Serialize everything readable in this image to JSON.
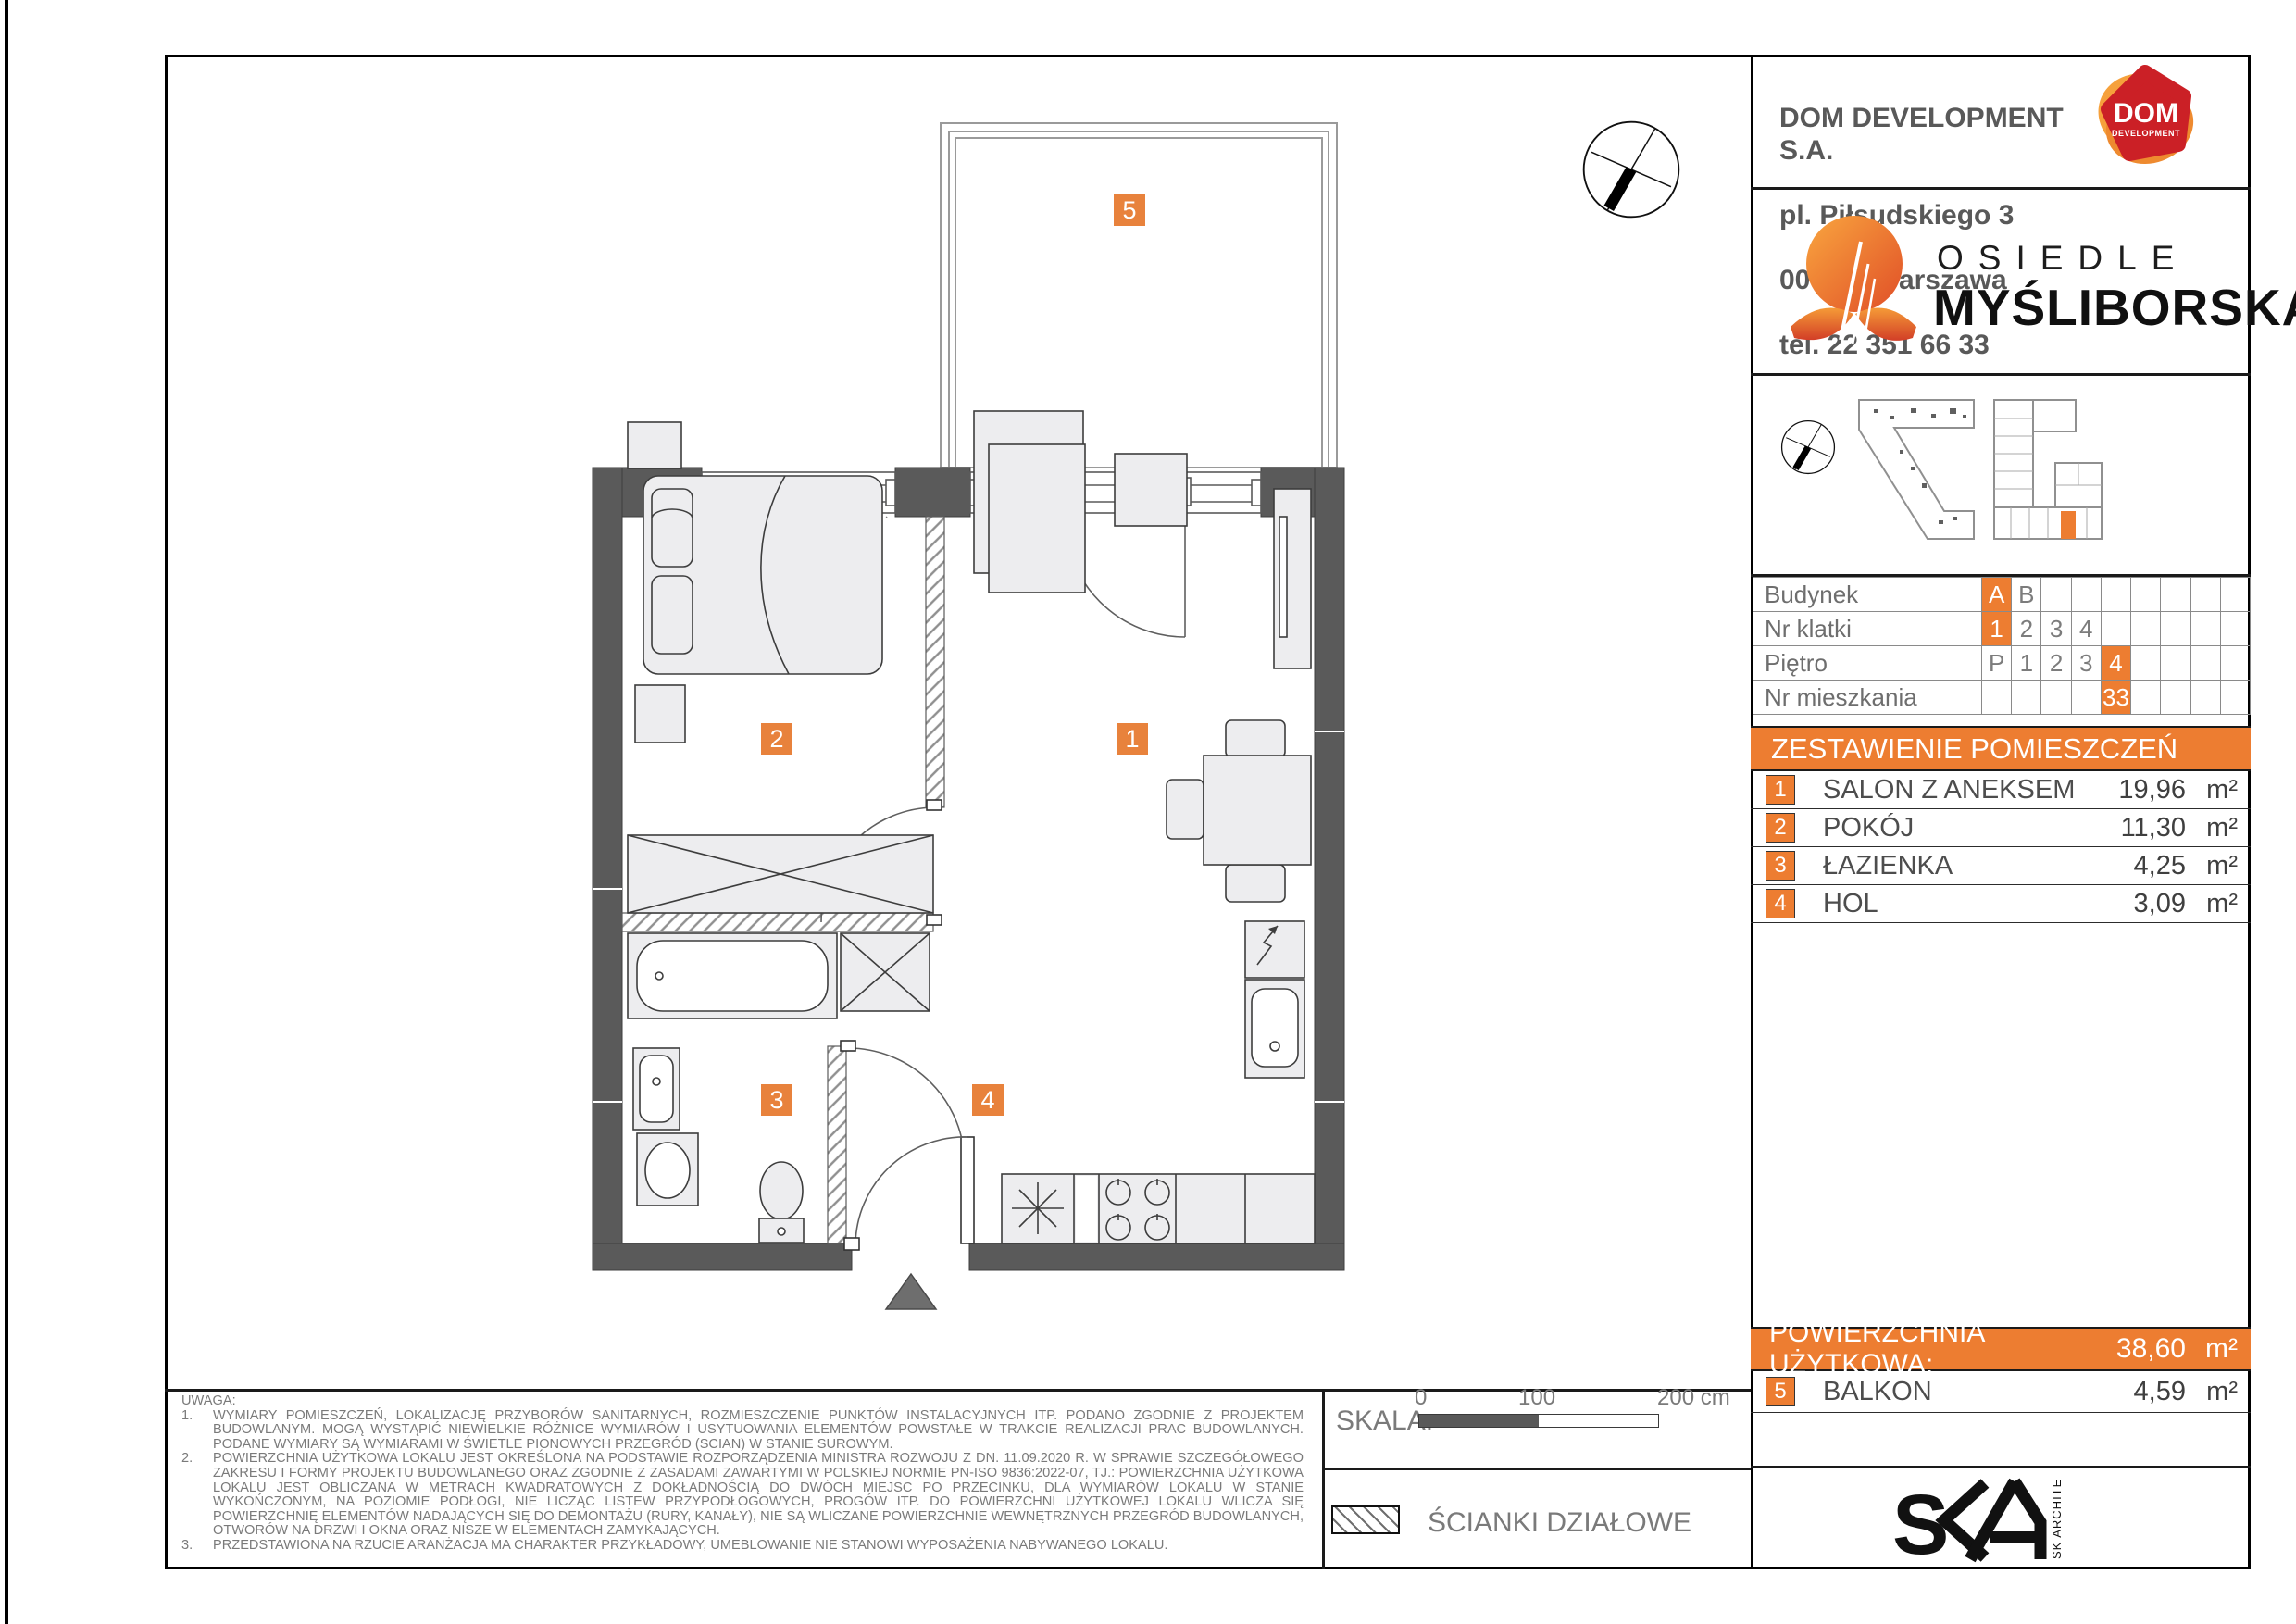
{
  "company": {
    "name": "DOM DEVELOPMENT S.A.",
    "address_line1": "pl. Piłsudskiego 3",
    "address_line2": "00-078 Warszawa",
    "phone": "tel. 22 351 66 33",
    "logo_text": "DOM",
    "logo_subtext": "DEVELOPMENT"
  },
  "project": {
    "prefix": "OSIEDLE",
    "name": "MYŚLIBORSKA"
  },
  "info_table": {
    "rows": [
      {
        "label": "Budynek",
        "cells": [
          {
            "t": "A",
            "hl": true
          },
          {
            "t": "B"
          },
          {},
          {},
          {},
          {},
          {},
          {},
          {}
        ]
      },
      {
        "label": "Nr klatki",
        "cells": [
          {
            "t": "1",
            "hl": true
          },
          {
            "t": "2"
          },
          {
            "t": "3"
          },
          {
            "t": "4"
          },
          {},
          {},
          {},
          {},
          {}
        ]
      },
      {
        "label": "Piętro",
        "cells": [
          {
            "t": "P"
          },
          {
            "t": "1"
          },
          {
            "t": "2"
          },
          {
            "t": "3"
          },
          {
            "t": "4",
            "hl": true
          },
          {},
          {},
          {},
          {}
        ]
      },
      {
        "label": "Nr mieszkania",
        "cells": [
          {},
          {},
          {},
          {},
          {
            "t": "33",
            "hl": true
          },
          {},
          {},
          {},
          {}
        ]
      }
    ]
  },
  "rooms": {
    "header": "ZESTAWIENIE POMIESZCZEŃ",
    "items": [
      {
        "num": "1",
        "name": "SALON Z ANEKSEM",
        "area": "19,96",
        "unit": "m²"
      },
      {
        "num": "2",
        "name": "POKÓJ",
        "area": "11,30",
        "unit": "m²"
      },
      {
        "num": "3",
        "name": "ŁAZIENKA",
        "area": "4,25",
        "unit": "m²"
      },
      {
        "num": "4",
        "name": "HOL",
        "area": "3,09",
        "unit": "m²"
      }
    ]
  },
  "summary": {
    "label": "POWIERZCHNIA UŻYTKOWA:",
    "value": "38,60",
    "unit": "m²",
    "balcony": {
      "num": "5",
      "name": "BALKON",
      "area": "4,59",
      "unit": "m²"
    }
  },
  "notes": {
    "title": "UWAGA:",
    "items": [
      {
        "num": "1.",
        "text": "WYMIARY POMIESZCZEŃ, LOKALIZACJĘ PRZYBORÓW SANITARNYCH, ROZMIESZCZENIE PUNKTÓW INSTALACYJNYCH ITP. PODANO ZGODNIE Z PROJEKTEM BUDOWLANYM. MOGĄ WYSTĄPIĆ NIEWIELKIE RÓŻNICE WYMIARÓW I USYTUOWANIA ELEMENTÓW POWSTAŁE W TRAKCIE REALIZACJI PRAC BUDOWLANYCH. PODANE WYMIARY SĄ WYMIARAMI W ŚWIETLE PIONOWYCH PRZEGRÓD (SCIAN) W STANIE SUROWYM."
      },
      {
        "num": "2.",
        "text": "POWIERZCHNIA UŻYTKOWA LOKALU JEST OKREŚLONA NA PODSTAWIE ROZPORZĄDZENIA MINISTRA ROZWOJU Z DN. 11.09.2020 R. W SPRAWIE SZCZEGÓŁOWEGO ZAKRESU I FORMY PROJEKTU BUDOWLANEGO ORAZ ZGODNIE Z ZASADAMI ZAWARTYMI W POLSKIEJ NORMIE PN-ISO 9836:2022-07, TJ.: POWIERZCHNIA UŻYTKOWA LOKALU JEST OBLICZANA W METRACH KWADRATOWYCH Z DOKŁADNOŚCIĄ DO DWÓCH MIEJSC PO PRZECINKU, DLA WYMIARÓW LOKALU W STANIE WYKOŃCZONYM, NA POZIOMIE PODŁOGI, NIE LICZĄC LISTEW PRZYPODŁOGOWYCH, PROGÓW ITP. DO POWIERZCHNI UŻYTKOWEJ LOKALU WLICZA SIĘ POWIERZCHNIĘ ELEMENTÓW NADAJĄCYCH SIĘ DO DEMONTAŻU (RURY, KANAŁY), NIE SĄ WLICZANE POWIERZCHNIE WEWNĘTRZNYCH PRZEGRÓD BUDOWLANYCH, OTWORÓW NA DRZWI I OKNA ORAZ NISZE W ELEMENTACH ZAMYKAJĄCYCH."
      },
      {
        "num": "3.",
        "text": "PRZEDSTAWIONA NA RZUCIE ARANŻACJA MA CHARAKTER PRZYKŁADOWY, UMEBLOWANIE NIE STANOWI WYPOSAŻENIA NABYWANEGO LOKALU."
      }
    ]
  },
  "scalebar": {
    "label": "SKALA:",
    "tick0": "0",
    "tick100": "100",
    "tick200": "200 cm"
  },
  "legend": {
    "partition_label": "ŚCIANKI DZIAŁOWE"
  },
  "architect": {
    "vertical_text": "SK ARCHITEKCI",
    "letter_s": "S"
  },
  "plan": {
    "labels": [
      {
        "num": "1",
        "room": "salon-z-aneksem"
      },
      {
        "num": "2",
        "room": "pokoj"
      },
      {
        "num": "3",
        "room": "lazienka"
      },
      {
        "num": "4",
        "room": "hol"
      },
      {
        "num": "5",
        "room": "balkon"
      }
    ]
  },
  "colors": {
    "accent": "#ED7D31",
    "wall": "#5A5A5A"
  }
}
